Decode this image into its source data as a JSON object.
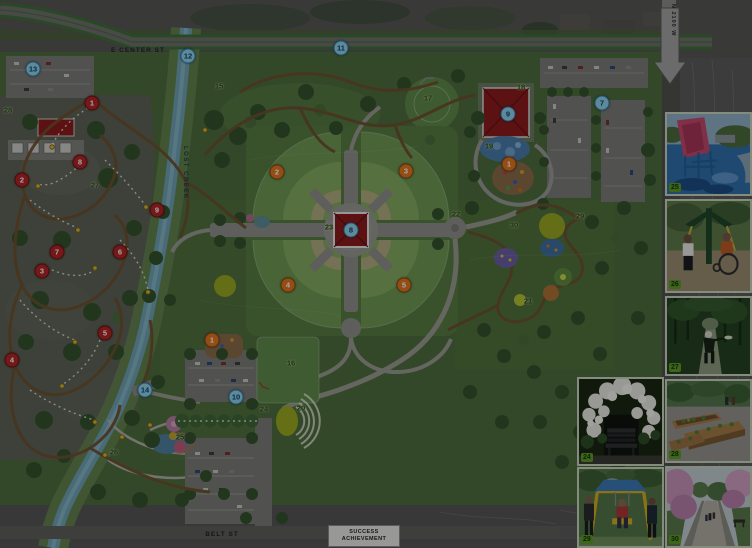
{
  "map": {
    "street_labels": {
      "e_center": "E CENTER ST",
      "lost_creek": "LOST CREEK",
      "n_2100_w": "N 2100 W",
      "belt": "BELT ST"
    },
    "sign": {
      "line1": "SUCCESS",
      "line2": "ACHIEVEMENT"
    },
    "markers": {
      "red": [
        {
          "n": "1",
          "x": 92,
          "y": 103
        },
        {
          "n": "2",
          "x": 22,
          "y": 180
        },
        {
          "n": "3",
          "x": 42,
          "y": 271
        },
        {
          "n": "4",
          "x": 12,
          "y": 360
        },
        {
          "n": "5",
          "x": 105,
          "y": 333
        },
        {
          "n": "6",
          "x": 120,
          "y": 252
        },
        {
          "n": "7",
          "x": 57,
          "y": 252
        },
        {
          "n": "8",
          "x": 80,
          "y": 162
        },
        {
          "n": "9",
          "x": 157,
          "y": 210
        }
      ],
      "orange": [
        {
          "n": "1",
          "x": 509,
          "y": 164
        },
        {
          "n": "1",
          "x": 212,
          "y": 340
        },
        {
          "n": "2",
          "x": 277,
          "y": 172
        },
        {
          "n": "3",
          "x": 406,
          "y": 171
        },
        {
          "n": "4",
          "x": 288,
          "y": 285
        },
        {
          "n": "5",
          "x": 404,
          "y": 285
        }
      ],
      "blue": [
        {
          "n": "7",
          "x": 602,
          "y": 103
        },
        {
          "n": "8",
          "x": 351,
          "y": 230
        },
        {
          "n": "9",
          "x": 508,
          "y": 114
        },
        {
          "n": "10",
          "x": 236,
          "y": 397
        },
        {
          "n": "11",
          "x": 341,
          "y": 48
        },
        {
          "n": "12",
          "x": 188,
          "y": 56
        },
        {
          "n": "13",
          "x": 33,
          "y": 69
        },
        {
          "n": "14",
          "x": 145,
          "y": 390
        }
      ],
      "green_labels": [
        {
          "n": "15",
          "x": 219,
          "y": 86
        },
        {
          "n": "16",
          "x": 291,
          "y": 363
        },
        {
          "n": "17",
          "x": 428,
          "y": 98
        },
        {
          "n": "18",
          "x": 521,
          "y": 87
        },
        {
          "n": "19",
          "x": 489,
          "y": 146
        },
        {
          "n": "20",
          "x": 301,
          "y": 408
        },
        {
          "n": "21",
          "x": 528,
          "y": 301
        },
        {
          "n": "22",
          "x": 456,
          "y": 214
        },
        {
          "n": "23",
          "x": 329,
          "y": 227
        },
        {
          "n": "24",
          "x": 264,
          "y": 409
        },
        {
          "n": "25",
          "x": 180,
          "y": 437
        },
        {
          "n": "26",
          "x": 114,
          "y": 452
        },
        {
          "n": "27",
          "x": 95,
          "y": 185
        },
        {
          "n": "28",
          "x": 8,
          "y": 110
        },
        {
          "n": "29",
          "x": 580,
          "y": 216
        },
        {
          "n": "30",
          "x": 514,
          "y": 225
        }
      ]
    },
    "colors": {
      "park_green": "#4d6c39",
      "creek": "#6fa2b2",
      "building_red": "#8d1717",
      "marker_red": "#b32222",
      "marker_orange": "#e2761b",
      "marker_blue": "#8fd0ea",
      "label_green": "#1c3a10",
      "badge_green": "#5d9a23"
    }
  },
  "photos": [
    {
      "name": "splash-pad-photo",
      "badge": "25"
    },
    {
      "name": "outdoor-fitness-photo",
      "badge": "26"
    },
    {
      "name": "disc-golf-photo",
      "badge": "27"
    },
    {
      "name": "arbor-bench-photo",
      "badge": "24"
    },
    {
      "name": "community-garden-photo",
      "badge": "28"
    },
    {
      "name": "accessible-swing-photo",
      "badge": "29"
    },
    {
      "name": "blossom-promenade-photo",
      "badge": "30"
    }
  ]
}
